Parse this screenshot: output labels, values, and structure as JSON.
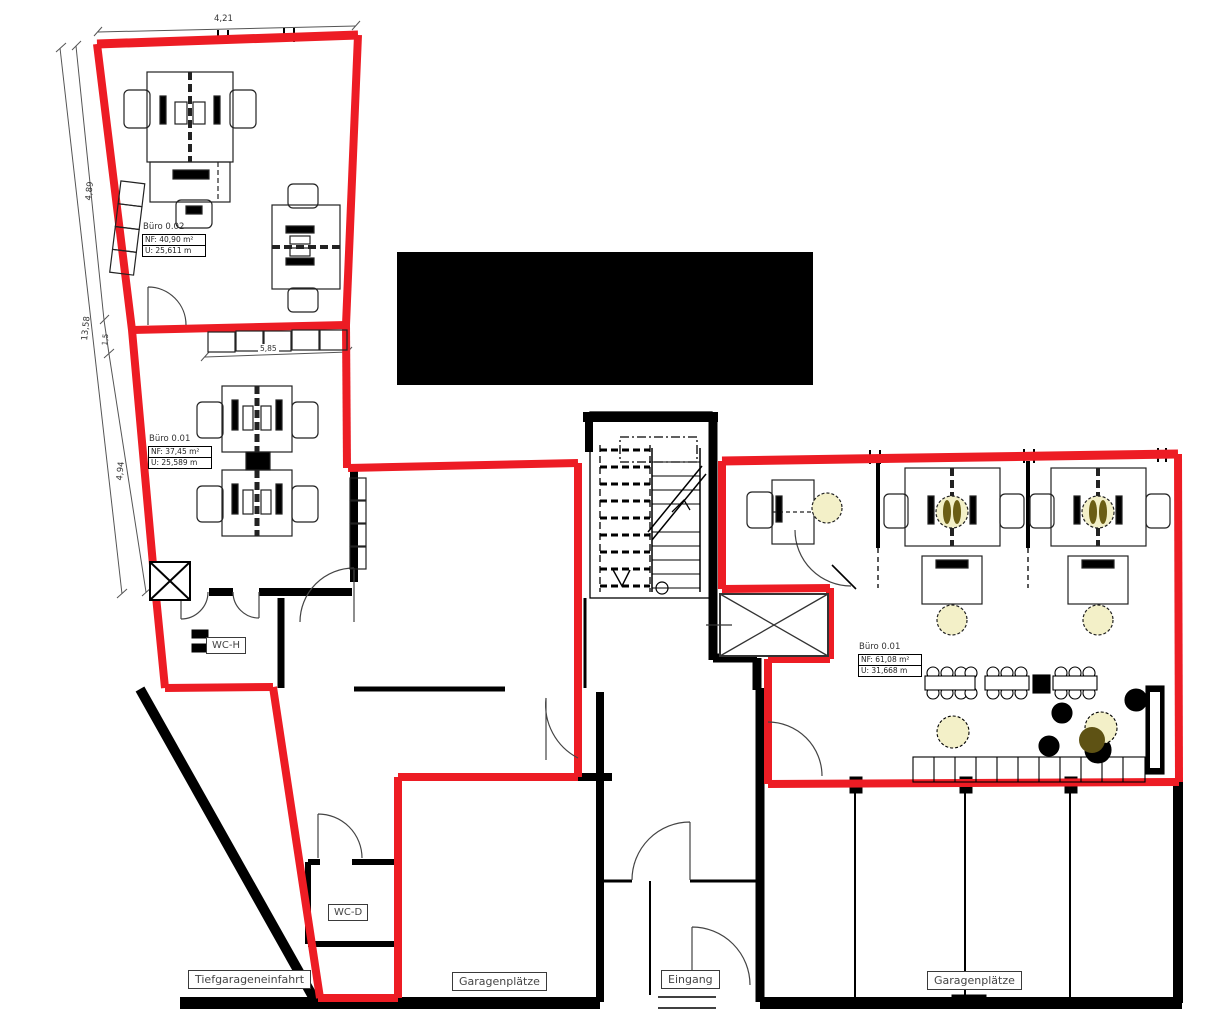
{
  "drawing": {
    "type": "floor-plan",
    "language": "de",
    "colors": {
      "unit_outline_red": "#ed1c24",
      "wall_black": "#000000",
      "plant_yellow": "#f3f0c8",
      "plant_olive": "#6b5e15"
    }
  },
  "rooms": {
    "buero_0_02": {
      "title": "Büro 0.02",
      "nf": "NF: 40,90 m²",
      "u": "U: 25,611 m"
    },
    "buero_0_01_left": {
      "title": "Büro 0.01",
      "nf": "NF: 37,45 m²",
      "u": "U: 25,589 m"
    },
    "buero_0_01_right": {
      "title": "Büro 0.01",
      "nf": "NF: 61,08 m²",
      "u": "U: 31,668 m"
    },
    "wc_h": {
      "label": "WC-H"
    },
    "wc_d": {
      "label": "WC-D"
    },
    "tiefgarageneinfahrt": {
      "label": "Tiefgarageneinfahrt"
    },
    "garagenplaetze_left": {
      "label": "Garagenplätze"
    },
    "eingang": {
      "label": "Eingang"
    },
    "garagenplaetze_right": {
      "label": "Garagenplätze"
    }
  },
  "dimensions": {
    "top": "4,21",
    "left_total": "13,58",
    "left_upper": "4,89",
    "left_mid": "1,5",
    "left_lower": "4,94",
    "cabinet_row": "5,85"
  }
}
